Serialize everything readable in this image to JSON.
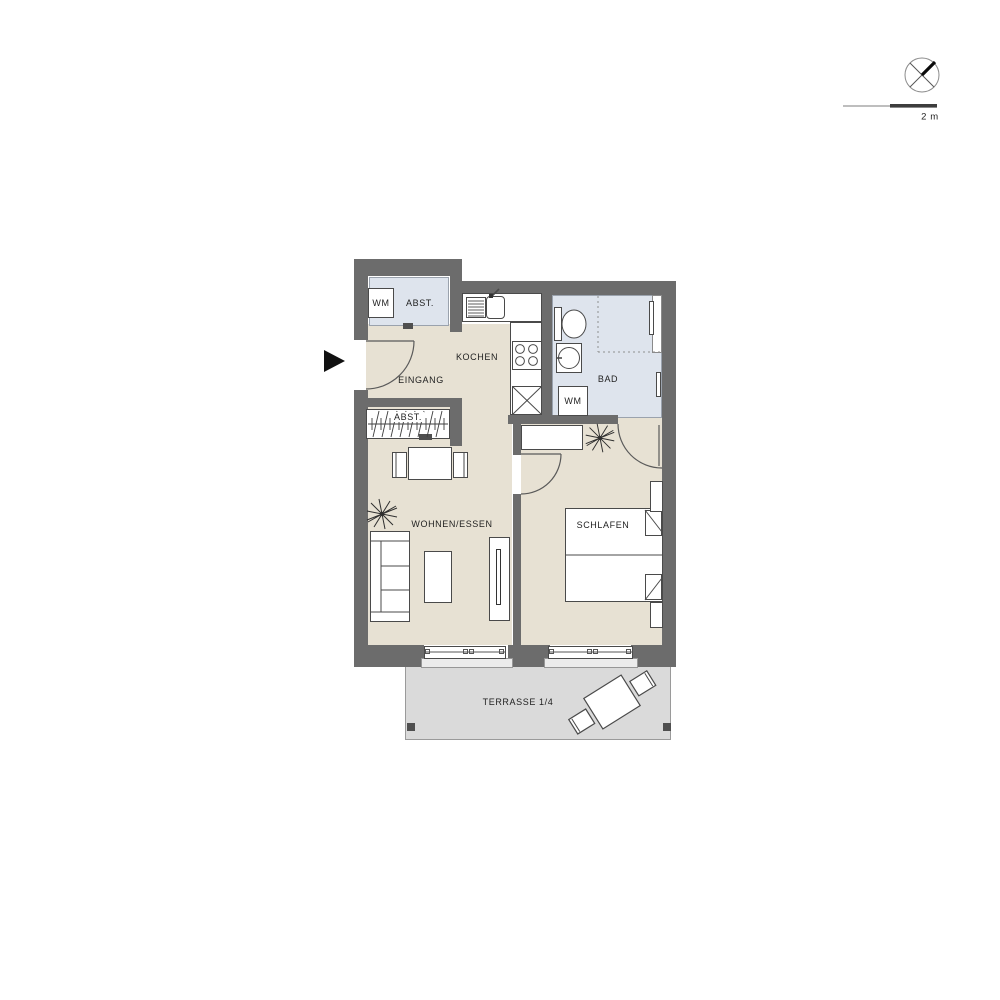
{
  "plan": {
    "title_note": "apartment floor plan",
    "labels": {
      "utility_wm": "WM",
      "utility_abst": "ABST.",
      "kitchen": "KOCHEN",
      "entrance": "EINGANG",
      "closet_abst": "ABST.",
      "bath": "BAD",
      "bath_wm": "WM",
      "living": "WOHNEN/ESSEN",
      "bedroom": "SCHLAFEN",
      "terrace": "TERRASSE 1/4"
    },
    "scale": {
      "label": "2 m"
    },
    "icons": {
      "compass": "compass-icon",
      "entrance_arrow": "entrance-arrow-icon",
      "plant_living": "plant-icon",
      "plant_bedroom": "plant-icon"
    },
    "colors": {
      "wall": "#6c6c6c",
      "floor": "#e7e1d3",
      "wet": "#dee4ed",
      "terrace": "#dadada",
      "line": "#4a4a4a"
    }
  }
}
